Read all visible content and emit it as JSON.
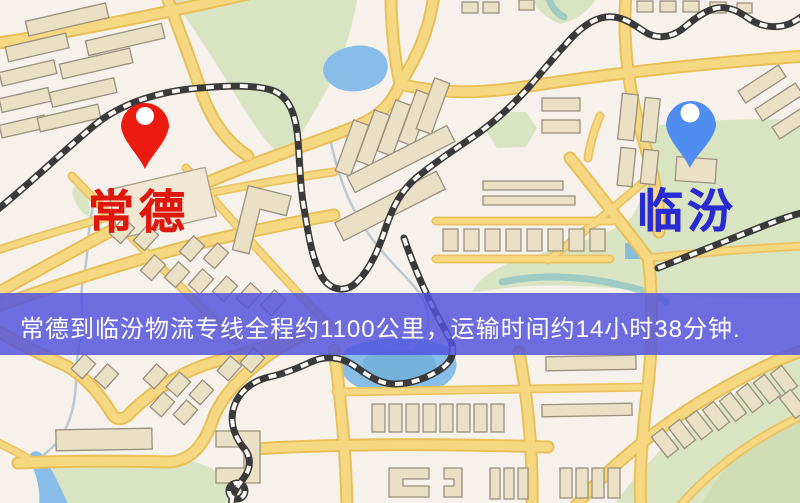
{
  "map": {
    "type": "road-map-illustration",
    "colors": {
      "background": "#f6f1ea",
      "road": "#f6d883",
      "road_edge": "#e8c05a",
      "park": "#d9e4c3",
      "water": "#87bde8",
      "building": "#eae0c6",
      "railway": "#3a3a3a",
      "origin_pin": "#ec1b10",
      "origin_text": "#e0170f",
      "destination_pin": "#4f8df0",
      "destination_text": "#2a2ad2",
      "banner_bg": "#5454de"
    }
  },
  "markers": [
    {
      "label": "常德",
      "icon": "map-pin-icon",
      "pin_color": "#ec1b10"
    },
    {
      "label": "临汾",
      "icon": "map-pin-icon",
      "pin_color": "#4f8df0"
    }
  ],
  "banner": {
    "text": "常德到临汾物流专线全程约1100公里，运输时间约14小时38分钟."
  }
}
